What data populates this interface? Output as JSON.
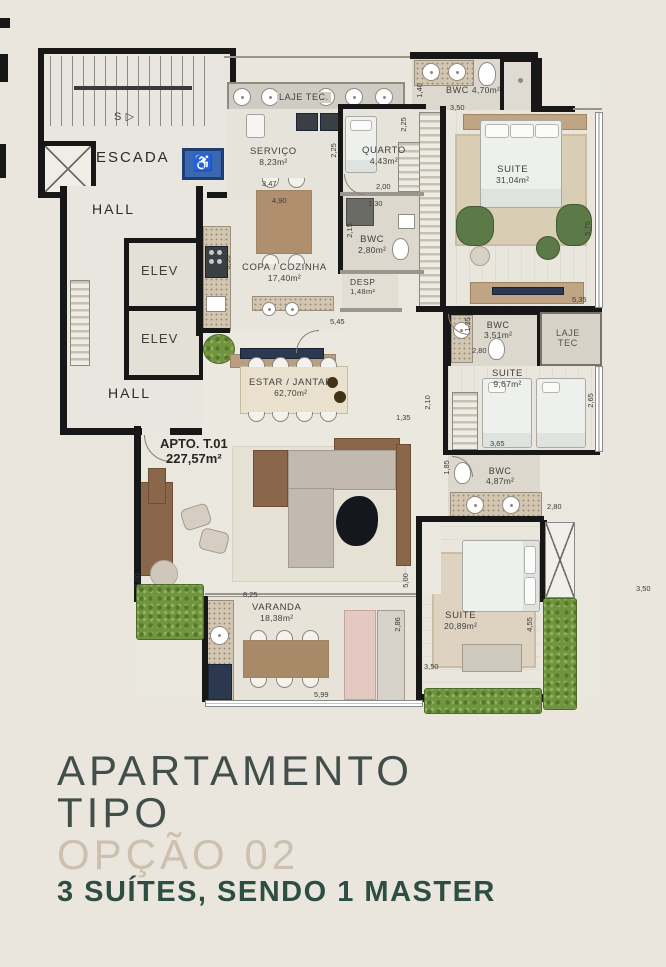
{
  "title": {
    "line1": "APARTAMENTO",
    "line2": "TIPO",
    "line3": "OPÇÃO 02",
    "line4": "3 SUÍTES, SENDO 1 MASTER"
  },
  "apartment": {
    "label": "APTO. T.01",
    "area": "227,57m²"
  },
  "rooms": {
    "escada": {
      "name": "ESCADA",
      "s": "S ▷"
    },
    "hall_top": {
      "name": "HALL"
    },
    "hall_bottom": {
      "name": "HALL"
    },
    "elev1": {
      "name": "ELEV"
    },
    "elev2": {
      "name": "ELEV"
    },
    "laje_top": {
      "name": "LAJE TEC."
    },
    "servico": {
      "name": "SERVIÇO",
      "area": "8,23m²"
    },
    "quarto": {
      "name": "QUARTO",
      "area": "4,43m²"
    },
    "bwc_social": {
      "name": "BWC",
      "area": "2,80m²"
    },
    "desp": {
      "name": "DESP",
      "area": "1,48m²"
    },
    "copa": {
      "name": "COPA / COZINHA",
      "area": "17,40m²"
    },
    "bwc_master": {
      "name": "BWC",
      "area": "4,70m²"
    },
    "suite_master": {
      "name": "SUITE",
      "area": "31,04m²"
    },
    "bwc_suite2": {
      "name": "BWC",
      "area": "3,51m²"
    },
    "laje_right": {
      "line1": "LAJE",
      "line2": "TEC"
    },
    "suite_2": {
      "name": "SUITE",
      "area": "9,67m²"
    },
    "bwc_suite3": {
      "name": "BWC",
      "area": "4,87m²"
    },
    "suite_3": {
      "name": "SUITE",
      "area": "20,89m²"
    },
    "lav": {
      "name": "LAV",
      "area": "2,84m²"
    },
    "estar": {
      "name": "ESTAR / JANTAR",
      "area": "62,70m²"
    },
    "varanda": {
      "name": "VARANDA",
      "area": "18,38m²"
    }
  },
  "dimensions": {
    "d140": "1,40",
    "d350a": "3,50",
    "d225a": "2,25",
    "d225b": "2,25",
    "d347": "3,47",
    "d490": "4,90",
    "d200": "2,00",
    "d130": "1,30",
    "d215": "2,15",
    "d355": "3,55",
    "d575": "5,75",
    "d535": "5,35",
    "d135a": "1,35",
    "d280a": "2,80",
    "d265": "2,65",
    "d365": "3,65",
    "d185": "1,85",
    "d280b": "2,80",
    "d210": "2,10",
    "d135b": "1,35",
    "d545": "5,45",
    "d500a": "5,00",
    "d500b": "5,00",
    "d825": "8,25",
    "d599": "5,99",
    "d286": "2,86",
    "d455": "4,55",
    "d350b": "3,50",
    "d350c": "3,50"
  },
  "colors": {
    "wall": "#171717",
    "accent_green": "#2d4f43",
    "muted_tan": "#cdc0ae",
    "plant": "#71953f",
    "wheelchair_blue": "#3a67b0"
  }
}
